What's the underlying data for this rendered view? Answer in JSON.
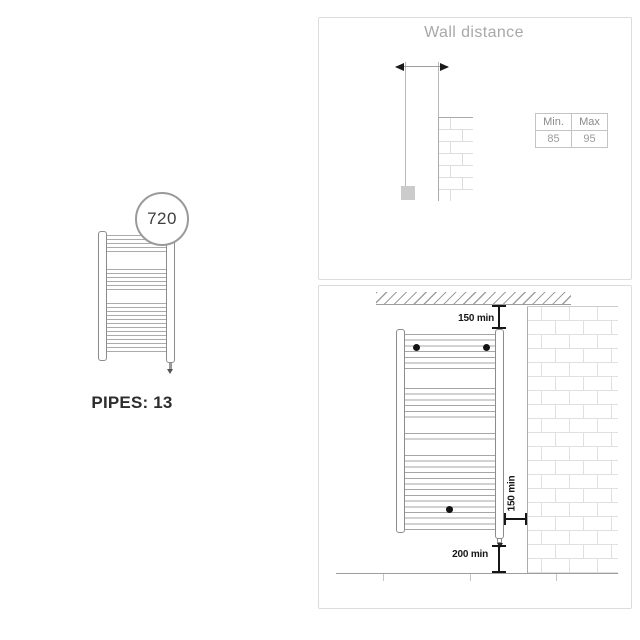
{
  "left_figure": {
    "dimension_badge": "720",
    "pipes_label": "PIPES: 13"
  },
  "wall_distance_panel": {
    "title": "Wall distance",
    "table": {
      "headers": [
        "Min.",
        "Max"
      ],
      "rows": [
        [
          "85",
          "95"
        ]
      ]
    }
  },
  "installation_panel": {
    "top_clearance": "150 min",
    "side_clearance": "150 min",
    "bottom_clearance": "200 min"
  },
  "colors": {
    "panel_border": "#dcdcdc",
    "title_text": "#a8a8a8",
    "table_text": "#8f8f8f",
    "diagram_line": "#9e9e9e",
    "radiator_outline": "#8c8c8c",
    "dimension_black": "#161616",
    "brick_joint": "#e0e0e0"
  }
}
